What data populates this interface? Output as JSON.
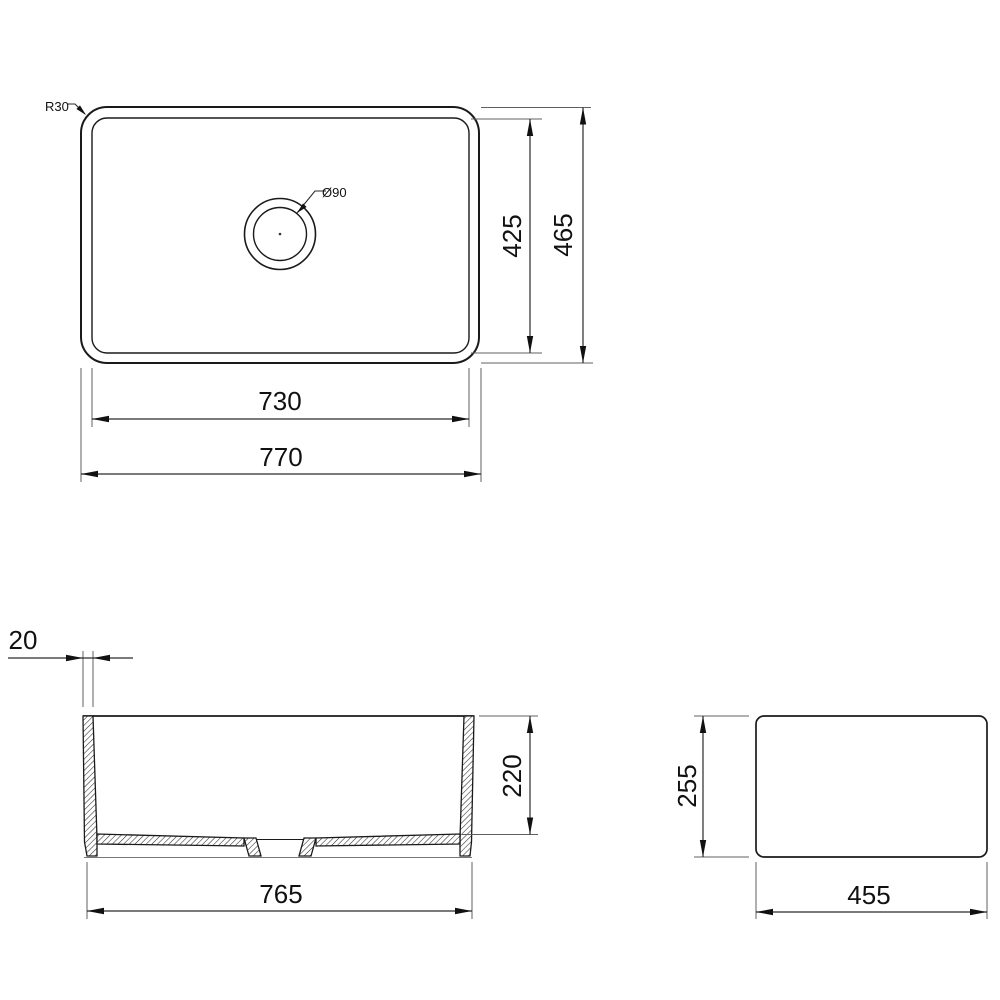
{
  "drawing": {
    "type": "sink-dimension-drawing",
    "background": "#ffffff",
    "line_color": "#1a1a1a",
    "views": {
      "top": {
        "radius": "R30",
        "drain": "Ø90",
        "width_inner": "730",
        "width_outer": "770",
        "height_inner": "425",
        "height_outer": "465"
      },
      "front": {
        "wall": "20",
        "depth": "220",
        "width": "765"
      },
      "side": {
        "height": "255",
        "width": "455"
      }
    }
  }
}
